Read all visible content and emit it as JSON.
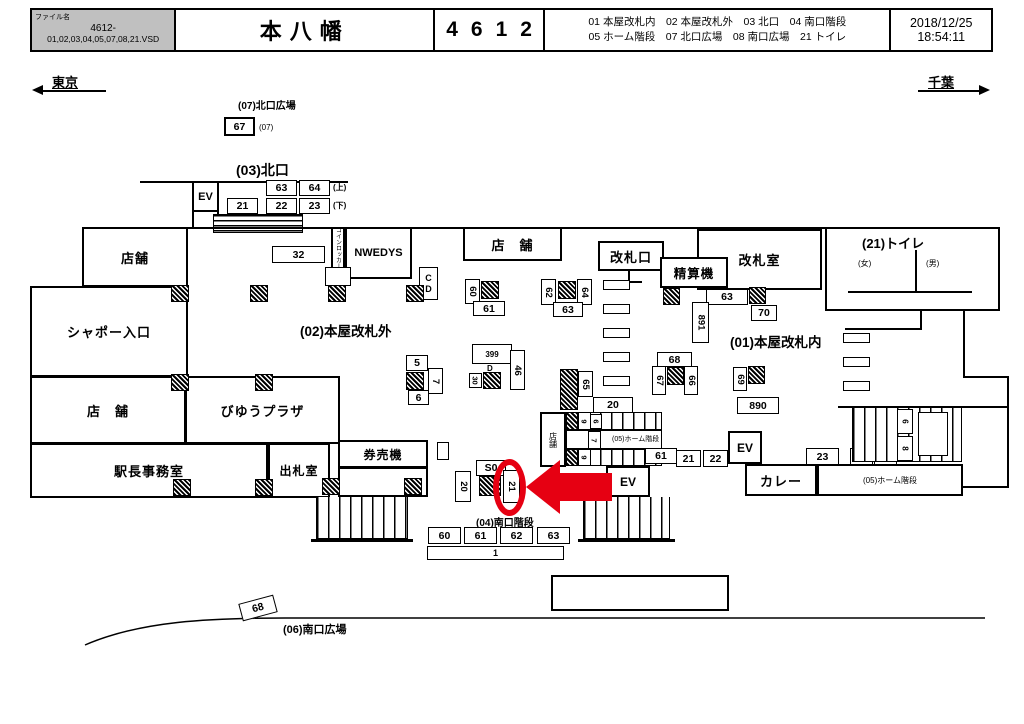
{
  "header": {
    "file_label": "ファイル名",
    "file_code": "4612-",
    "file_name": "01,02,03,04,05,07,08,21.VSD",
    "station": "本八幡",
    "station_no": "4612",
    "legend1": "01 本屋改札内　02 本屋改札外　03 北口　04 南口階段",
    "legend2": "05 ホーム階段　07 北口広場　08 南口広場　21 トイレ",
    "date": "2018/12/25",
    "time": "18:54:11"
  },
  "compass": {
    "west": "東京",
    "east": "千葉"
  },
  "areas": {
    "a07": "(07)北口広場",
    "a07_note": "(07)",
    "a03": "(03)北口",
    "a02": "(02)本屋改札外",
    "a01": "(01)本屋改札内",
    "a04": "(04)南口階段",
    "a05c": "(05)ホーム階段",
    "a05r": "(05)ホーム階段",
    "a06": "(06)南口広場",
    "a21": "(21)トイレ",
    "female": "(女)",
    "male": "(男)",
    "up": "(上)",
    "down": "(下)"
  },
  "rooms": {
    "tenpo_nw": "店舗",
    "chapeau": "シャポー入口",
    "tenpo_w": "店　舗",
    "master": "駅長事務室",
    "viewplaza": "びゆうプラザ",
    "shussatsu": "出札室",
    "kenbaiki": "券売機",
    "nwedys": "NWEDYS",
    "locker": "コインロッカー",
    "tenpo_top": "店　舗",
    "gate": "改札口",
    "seisanki": "精算機",
    "gateoffice": "改札室",
    "curry": "カレー",
    "tenpo_st": "店舗"
  },
  "ev": {
    "north": "EV",
    "center": "EV",
    "east": "EV"
  },
  "signs": {
    "plaza67": "67",
    "n63": "63",
    "n64": "64",
    "n21": "21",
    "n22": "22",
    "n23": "23",
    "locker32": "32",
    "cd_c": "C",
    "cd_d": "D",
    "g60": "60",
    "g61": "61",
    "g62": "62",
    "g63": "63",
    "g64": "64",
    "g65": "65",
    "c68": "68",
    "c67": "67",
    "c66": "66",
    "c69": "69",
    "o63": "63",
    "o70": "70",
    "o891": "891",
    "o890": "890",
    "k5": "5",
    "k6": "6",
    "k7": "7",
    "d399": "399",
    "dd": "D",
    "d46": "46",
    "d30": "30",
    "st20": "20",
    "st9a": "9",
    "st6": "6",
    "st7": "7",
    "st9b": "9",
    "st61": "61",
    "s0": "S0",
    "s20": "20",
    "s21": "21",
    "row21": "21",
    "row22": "22",
    "row23": "23",
    "row64": "64",
    "row60": "60",
    "p6": "6",
    "p8": "8",
    "b60": "60",
    "b61": "61",
    "b62": "62",
    "b63": "63",
    "b1": "1",
    "curve68": "68"
  }
}
